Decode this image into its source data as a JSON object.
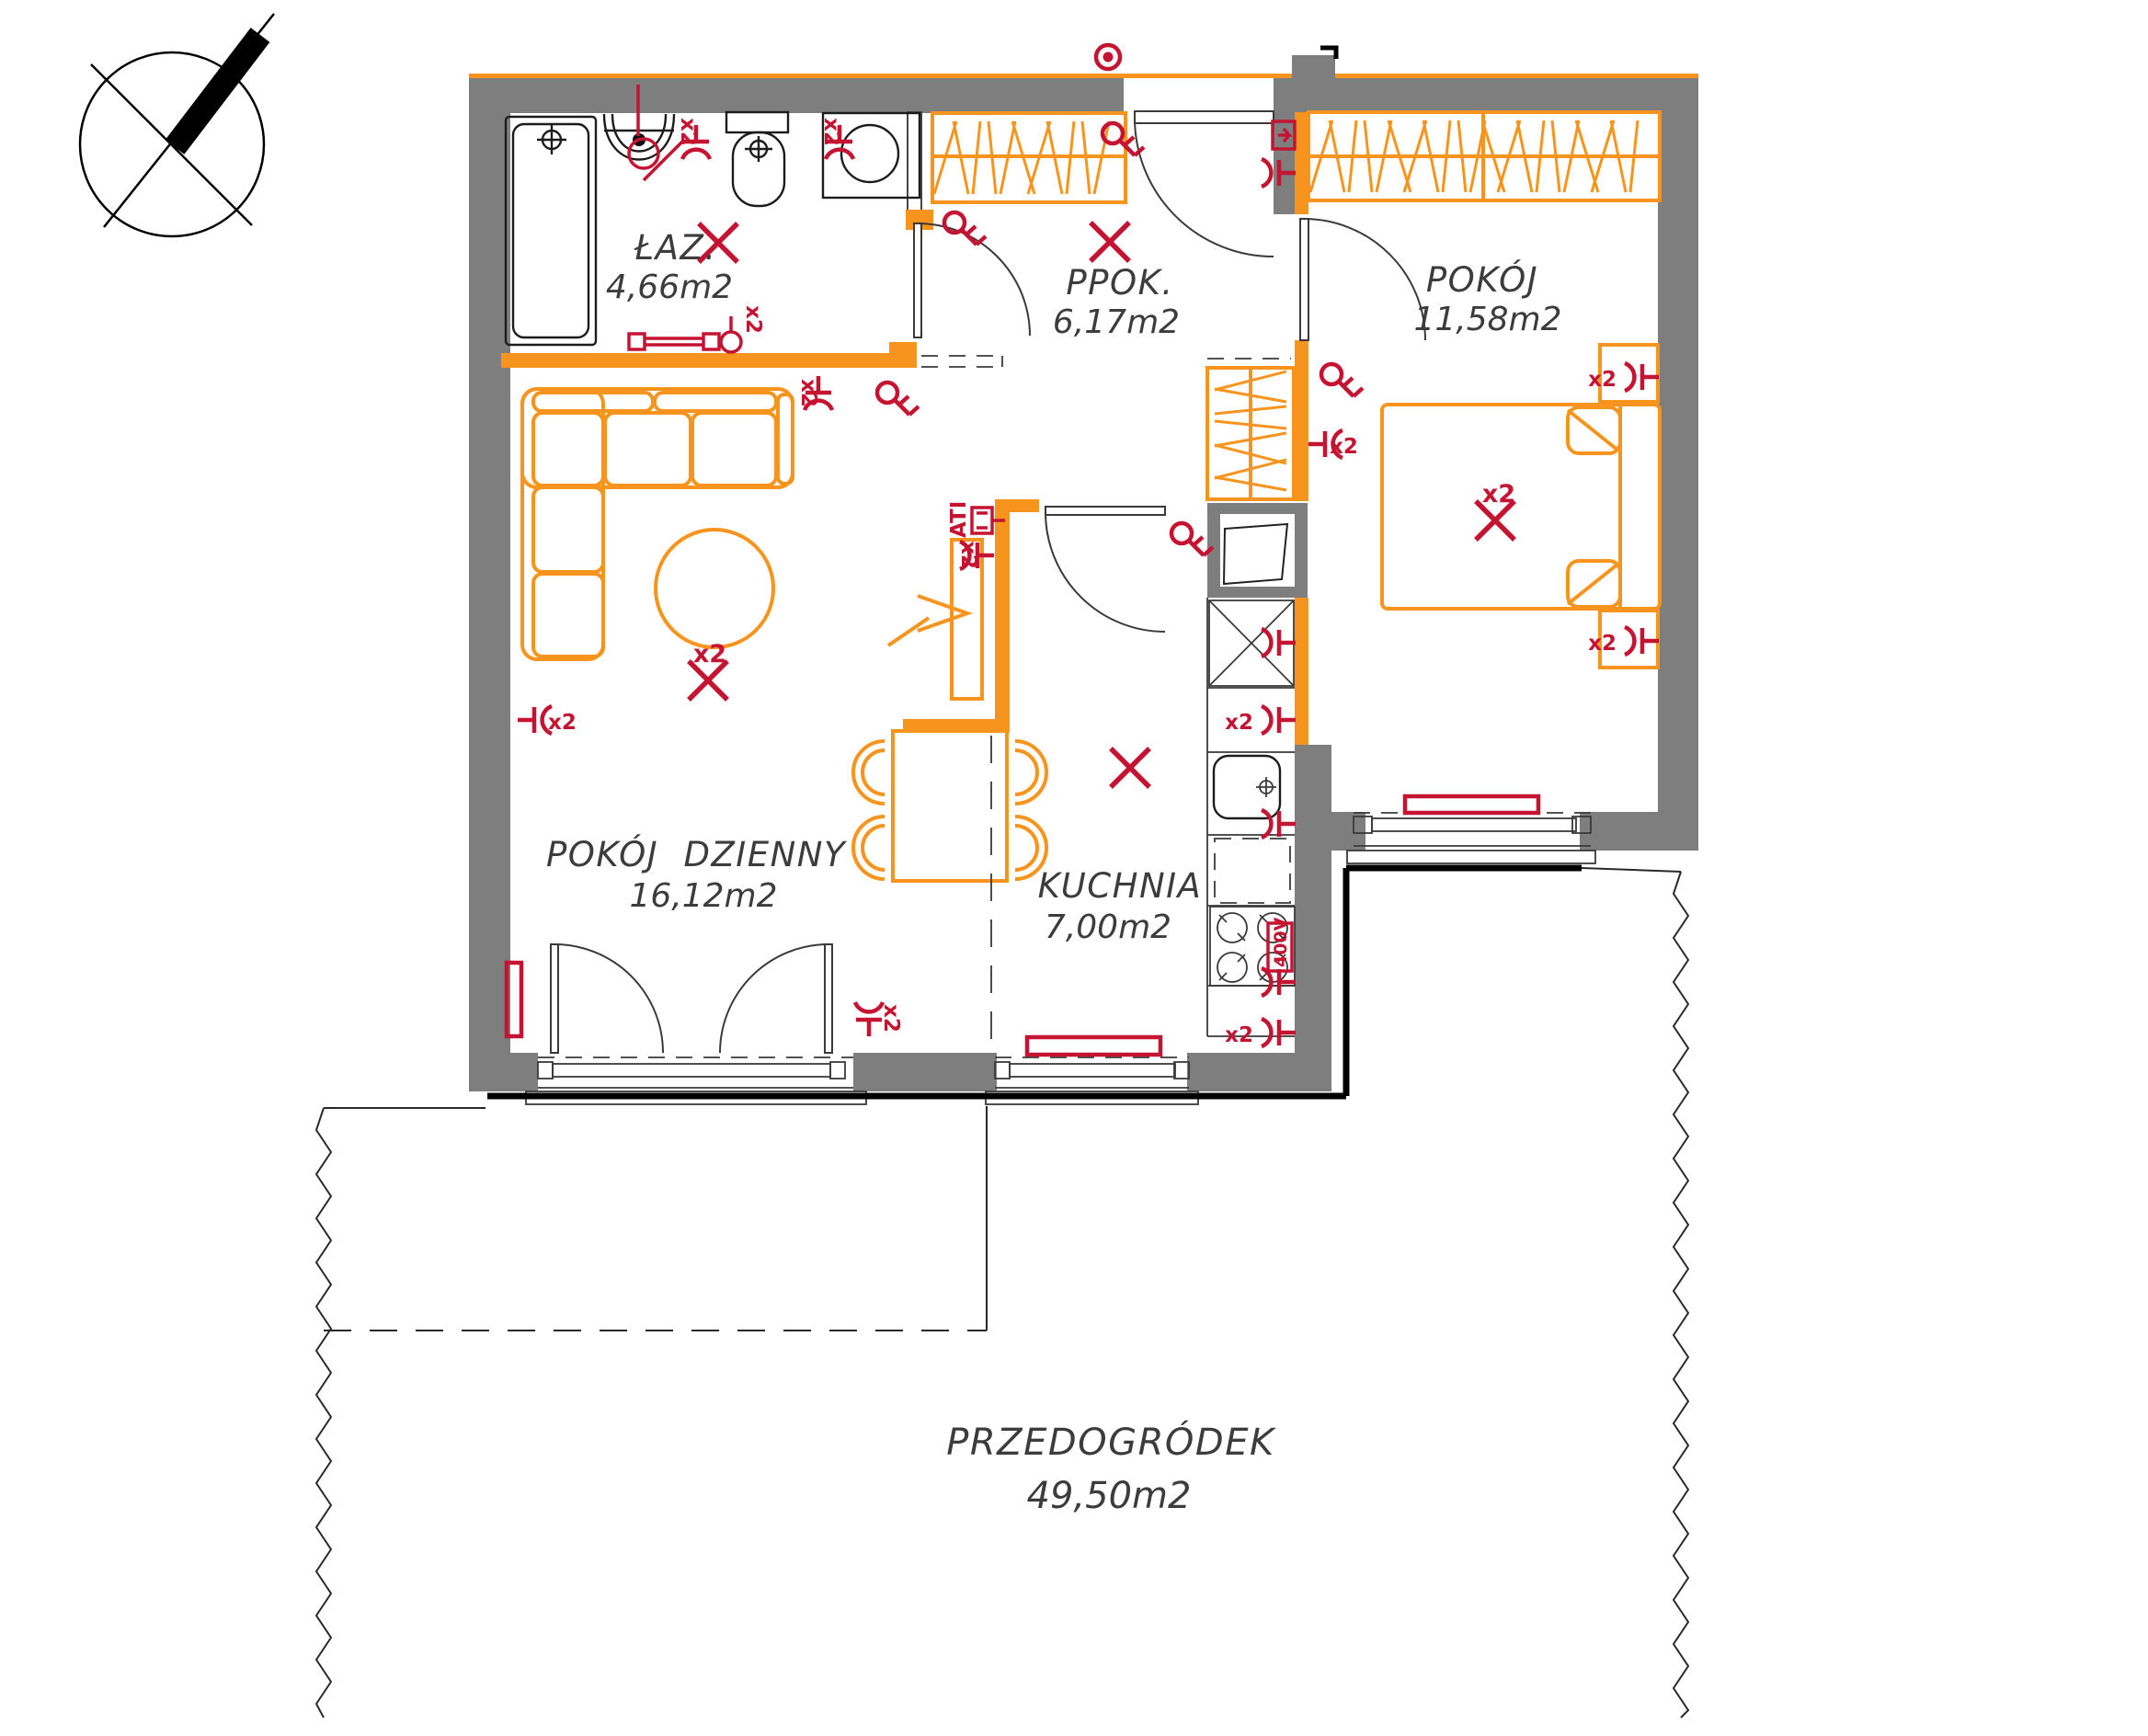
{
  "plan_title": "apartment-floor-plan",
  "rooms": [
    {
      "id": "bathroom",
      "label": "ŁAZ.",
      "area": "4,66m2"
    },
    {
      "id": "hallway",
      "label": "PPOK.",
      "area": "6,17m2"
    },
    {
      "id": "bedroom",
      "label": "POKÓJ",
      "area": "11,58m2"
    },
    {
      "id": "living-room",
      "label": "POKÓJ DZIENNY",
      "area": "16,12m2"
    },
    {
      "id": "kitchen",
      "label": "KUCHNIA",
      "area": "7,00m2"
    },
    {
      "id": "front-garden",
      "label": "PRZEDOGRÓDEK",
      "area": "49,50m2"
    }
  ],
  "electrical": {
    "double": "x2",
    "power": "400V",
    "antenna": "ATI"
  },
  "colors": {
    "wall_gray": "#7e7e7e",
    "orange": "#F7941D",
    "red": "#C51332",
    "line": "#1c1c1c",
    "text": "#3c3c3c"
  }
}
